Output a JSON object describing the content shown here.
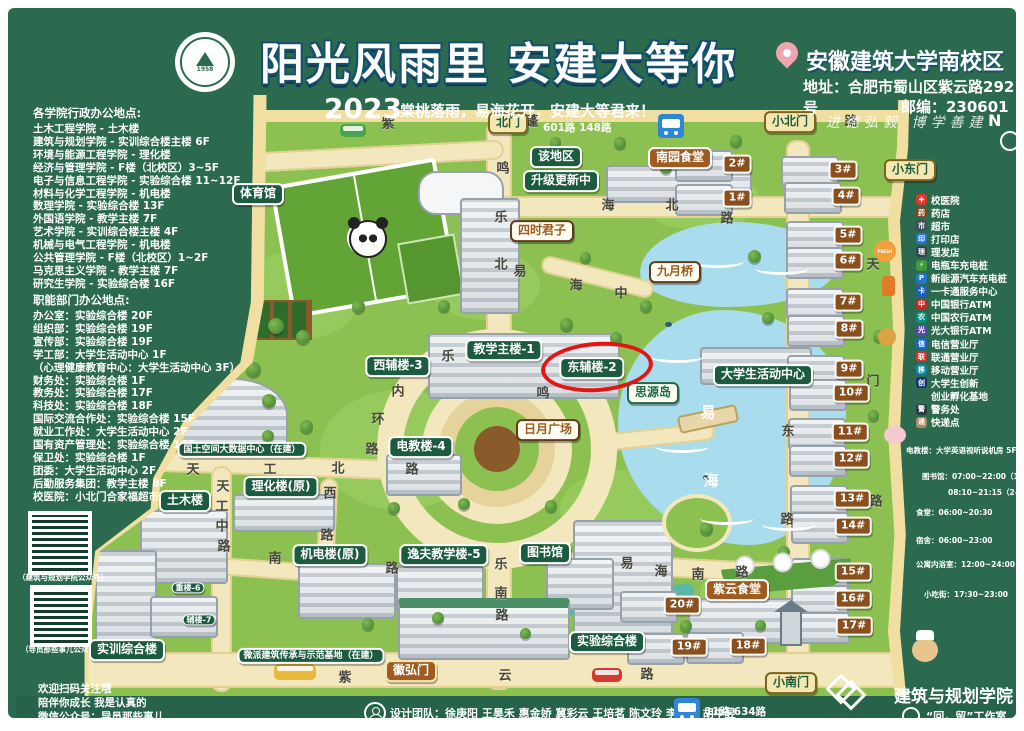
{
  "header": {
    "seal_year": "1958",
    "title": "阳光风雨里 安建大等你",
    "year": "2023",
    "subtitle": "棠桃落雨，易海花开，安建大等君来！",
    "campus": "安徽建筑大学南校区",
    "address": "地址：合肥市蜀山区紫云路292号",
    "postcode": "邮编：230601",
    "motto": "进德弘毅 博学善建",
    "compass": "N"
  },
  "college_offices": {
    "title": "各学院行政办公地点:",
    "items": [
      "土木工程学院 - 土木楼",
      "建筑与规划学院 - 实训综合楼主楼 6F",
      "环境与能源工程学院 - 理化楼",
      "经济与管理学院 - F楼（北校区）3~5F",
      "电子与信息工程学院 - 实验综合楼 11~12F",
      "材料与化学工程学院 - 机电楼",
      "数理学院 - 实验综合楼 13F",
      "外国语学院 - 教学主楼 7F",
      "艺术学院 - 实训综合楼主楼 4F",
      "机械与电气工程学院 - 机电楼",
      "公共管理学院 - F楼（北校区）1~2F",
      "马克思主义学院 - 教学主楼 7F",
      "研究生学院 - 实验综合楼 16F"
    ]
  },
  "department_offices": {
    "title": "职能部门办公地点:",
    "items": [
      "办公室：实验综合楼 20F",
      "组织部：实验综合楼 19F",
      "宣传部：实验综合楼 19F",
      "学工部：大学生活动中心 1F",
      "（心理健康教育中心：大学生活动中心 3F）",
      "财务处：实验综合楼 1F",
      "教务处：实验综合楼 17F",
      "科技处：实验综合楼 18F",
      "国际交流合作处：实验综合楼 15F",
      "就业工作处：大学生活动中心 2F",
      "国有资产管理处：实验综合楼 16F",
      "保卫处：实验综合楼 1F",
      "团委：大学生活动中心 2F",
      "后勤服务集团：教学主楼 8F",
      "校医院：小北门合家福超市旁边"
    ]
  },
  "legend": {
    "items": [
      {
        "label": "校医院",
        "color": "#d93a2f",
        "glyph": "✚"
      },
      {
        "label": "药店",
        "color": "#7a4a21",
        "glyph": "药"
      },
      {
        "label": "超市",
        "color": "#3d4f5c",
        "glyph": "市"
      },
      {
        "label": "打印店",
        "color": "#2277cc",
        "glyph": "印"
      },
      {
        "label": "理发店",
        "color": "#32424e",
        "glyph": "理"
      },
      {
        "label": "电瓶车充电桩",
        "color": "#3f9a3a",
        "glyph": "⚡"
      },
      {
        "label": "新能源汽车充电桩",
        "color": "#2277cc",
        "glyph": "P"
      },
      {
        "label": "一卡通服务中心",
        "color": "#1b5fb8",
        "glyph": "卡"
      },
      {
        "label": "中国银行ATM",
        "color": "#c22b23",
        "glyph": "中"
      },
      {
        "label": "中国农行ATM",
        "color": "#0e8e7c",
        "glyph": "农"
      },
      {
        "label": "光大银行ATM",
        "color": "#5448a8",
        "glyph": "光"
      },
      {
        "label": "电信营业厅",
        "color": "#1b66c9",
        "glyph": "信"
      },
      {
        "label": "联通营业厅",
        "color": "#d0352c",
        "glyph": "联"
      },
      {
        "label": "移动营业厅",
        "color": "#0f8aa0",
        "glyph": "移"
      },
      {
        "label": "大学生创新",
        "color": "#15356e",
        "glyph": "创"
      },
      {
        "label": "创业孵化基地",
        "color": "",
        "glyph": ""
      },
      {
        "label": "警务处",
        "color": "#2c3a45",
        "glyph": "警"
      },
      {
        "label": "快递点",
        "color": "#b08968",
        "glyph": "递"
      }
    ]
  },
  "hours": {
    "lines": [
      {
        "t": "电教楼：大学英语视听说机房 5F",
        "x": 906,
        "y": 445
      },
      {
        "t": "图书馆：07:00~22:00（1F）",
        "x": 922,
        "y": 471
      },
      {
        "t": "08:10~21:15（2-5F）",
        "x": 948,
        "y": 487
      },
      {
        "t": "食堂：06:00~20:30",
        "x": 916,
        "y": 507
      },
      {
        "t": "宿舍：06:00~23:00",
        "x": 916,
        "y": 535
      },
      {
        "t": "公寓内浴室：12:00~24:00",
        "x": 916,
        "y": 559
      },
      {
        "t": "小吃街：17:30~23:00",
        "x": 924,
        "y": 589
      }
    ]
  },
  "qr_panel": {
    "caption1": "（建筑与规划学院公众号）",
    "caption2": "（导员那些事儿公众号）",
    "line1": "欢迎扫码关注哦",
    "line2": "陪伴你成长 我是认真的",
    "line3": "微信公众号：导员那些事儿"
  },
  "footer": {
    "team": "设计团队：徐庚阳 王昊禾 惠金娇 冀彩云 王培茗 陈文玲 李云柯 胡中昱",
    "college": "建筑与规划学院",
    "studio": "“回，留”工作室"
  },
  "buses": {
    "north": "601路 148路",
    "south": "11路 634路"
  },
  "map": {
    "labels": [
      {
        "t": "北门",
        "x": 508,
        "y": 123,
        "k": "gate"
      },
      {
        "t": "小北门",
        "x": 790,
        "y": 122,
        "k": "gate"
      },
      {
        "t": "小东门",
        "x": 910,
        "y": 170,
        "k": "gate"
      },
      {
        "t": "小南门",
        "x": 791,
        "y": 683,
        "k": "gate"
      },
      {
        "t": "徽弘门",
        "x": 411,
        "y": 671,
        "k": "gateb"
      },
      {
        "t": "体育馆",
        "x": 258,
        "y": 194,
        "k": "bldg"
      },
      {
        "t": "该地区",
        "x": 556,
        "y": 157,
        "k": "bldg"
      },
      {
        "t": "升级更新中",
        "x": 561,
        "y": 181,
        "k": "bldg"
      },
      {
        "t": "教学主楼-1",
        "x": 504,
        "y": 350,
        "k": "bldg"
      },
      {
        "t": "西辅楼-3",
        "x": 398,
        "y": 366,
        "k": "bldg"
      },
      {
        "t": "东辅楼-2",
        "x": 592,
        "y": 368,
        "k": "bldg",
        "hl": 1
      },
      {
        "t": "大学生活动中心",
        "x": 763,
        "y": 375,
        "k": "bldg"
      },
      {
        "t": "电教楼-4",
        "x": 421,
        "y": 447,
        "k": "bldg"
      },
      {
        "t": "国土空间大数据中心（在建）",
        "x": 242,
        "y": 450,
        "k": "bldg",
        "s": "s"
      },
      {
        "t": "土木楼",
        "x": 185,
        "y": 501,
        "k": "bldg"
      },
      {
        "t": "理化楼(原)",
        "x": 281,
        "y": 487,
        "k": "bldg"
      },
      {
        "t": "机电楼(原)",
        "x": 330,
        "y": 555,
        "k": "bldg"
      },
      {
        "t": "逸夫教学楼-5",
        "x": 444,
        "y": 555,
        "k": "bldg"
      },
      {
        "t": "图书馆",
        "x": 545,
        "y": 553,
        "k": "bldg"
      },
      {
        "t": "实验综合楼",
        "x": 607,
        "y": 642,
        "k": "bldg"
      },
      {
        "t": "实训综合楼",
        "x": 127,
        "y": 650,
        "k": "bldg"
      },
      {
        "t": "微派建筑传承与示范基地（在建）",
        "x": 311,
        "y": 656,
        "k": "bldg",
        "s": "s"
      },
      {
        "t": "重楼-6",
        "x": 188,
        "y": 588,
        "k": "bldg",
        "s": "t"
      },
      {
        "t": "辅楼-7",
        "x": 199,
        "y": 620,
        "k": "bldg",
        "s": "t"
      },
      {
        "t": "四时君子",
        "x": 542,
        "y": 231,
        "k": "spot"
      },
      {
        "t": "九月桥",
        "x": 675,
        "y": 272,
        "k": "spot"
      },
      {
        "t": "日月广场",
        "x": 548,
        "y": 430,
        "k": "spot"
      },
      {
        "t": "思源岛",
        "x": 653,
        "y": 393,
        "k": "island"
      },
      {
        "t": "南园食堂",
        "x": 680,
        "y": 158,
        "k": "food"
      },
      {
        "t": "紫云食堂",
        "x": 737,
        "y": 590,
        "k": "food"
      },
      {
        "t": "1#",
        "x": 737,
        "y": 198,
        "k": "dorm"
      },
      {
        "t": "2#",
        "x": 737,
        "y": 164,
        "k": "dorm"
      },
      {
        "t": "3#",
        "x": 843,
        "y": 170,
        "k": "dorm"
      },
      {
        "t": "4#",
        "x": 846,
        "y": 196,
        "k": "dorm"
      },
      {
        "t": "5#",
        "x": 848,
        "y": 235,
        "k": "dorm"
      },
      {
        "t": "6#",
        "x": 848,
        "y": 261,
        "k": "dorm"
      },
      {
        "t": "7#",
        "x": 848,
        "y": 302,
        "k": "dorm"
      },
      {
        "t": "8#",
        "x": 849,
        "y": 329,
        "k": "dorm"
      },
      {
        "t": "9#",
        "x": 849,
        "y": 369,
        "k": "dorm"
      },
      {
        "t": "10#",
        "x": 851,
        "y": 393,
        "k": "dorm"
      },
      {
        "t": "11#",
        "x": 850,
        "y": 432,
        "k": "dorm"
      },
      {
        "t": "12#",
        "x": 851,
        "y": 459,
        "k": "dorm"
      },
      {
        "t": "13#",
        "x": 852,
        "y": 499,
        "k": "dorm"
      },
      {
        "t": "14#",
        "x": 853,
        "y": 526,
        "k": "dorm"
      },
      {
        "t": "15#",
        "x": 853,
        "y": 572,
        "k": "dorm"
      },
      {
        "t": "16#",
        "x": 853,
        "y": 599,
        "k": "dorm"
      },
      {
        "t": "17#",
        "x": 854,
        "y": 626,
        "k": "dorm"
      },
      {
        "t": "18#",
        "x": 748,
        "y": 646,
        "k": "dorm"
      },
      {
        "t": "19#",
        "x": 689,
        "y": 647,
        "k": "dorm"
      },
      {
        "t": "20#",
        "x": 682,
        "y": 605,
        "k": "dorm"
      }
    ],
    "road_chars": [
      {
        "c": "紫",
        "x": 388,
        "y": 122
      },
      {
        "c": "蓬",
        "x": 532,
        "y": 120
      },
      {
        "c": "路",
        "x": 851,
        "y": 120
      },
      {
        "c": "鸣",
        "x": 503,
        "y": 167
      },
      {
        "c": "乐",
        "x": 501,
        "y": 216
      },
      {
        "c": "北",
        "x": 501,
        "y": 263
      },
      {
        "c": "海",
        "x": 608,
        "y": 204
      },
      {
        "c": "北",
        "x": 672,
        "y": 204
      },
      {
        "c": "路",
        "x": 727,
        "y": 217
      },
      {
        "c": "易",
        "x": 520,
        "y": 270
      },
      {
        "c": "海",
        "x": 576,
        "y": 284
      },
      {
        "c": "中",
        "x": 621,
        "y": 292
      },
      {
        "c": "乐",
        "x": 448,
        "y": 355
      },
      {
        "c": "鸣",
        "x": 543,
        "y": 392
      },
      {
        "c": "内",
        "x": 398,
        "y": 390
      },
      {
        "c": "环",
        "x": 378,
        "y": 418
      },
      {
        "c": "路",
        "x": 372,
        "y": 448
      },
      {
        "c": "天",
        "x": 193,
        "y": 468
      },
      {
        "c": "工",
        "x": 270,
        "y": 468
      },
      {
        "c": "北",
        "x": 338,
        "y": 467
      },
      {
        "c": "路",
        "x": 412,
        "y": 468
      },
      {
        "c": "天",
        "x": 223,
        "y": 485
      },
      {
        "c": "工",
        "x": 222,
        "y": 505
      },
      {
        "c": "中",
        "x": 222,
        "y": 525
      },
      {
        "c": "路",
        "x": 224,
        "y": 545
      },
      {
        "c": "西",
        "x": 330,
        "y": 492
      },
      {
        "c": "路",
        "x": 327,
        "y": 534
      },
      {
        "c": "南",
        "x": 275,
        "y": 557
      },
      {
        "c": "路",
        "x": 392,
        "y": 567
      },
      {
        "c": "乐",
        "x": 501,
        "y": 563
      },
      {
        "c": "南",
        "x": 501,
        "y": 592
      },
      {
        "c": "路",
        "x": 502,
        "y": 614
      },
      {
        "c": "易",
        "x": 627,
        "y": 562
      },
      {
        "c": "海",
        "x": 661,
        "y": 570
      },
      {
        "c": "南",
        "x": 698,
        "y": 573
      },
      {
        "c": "路",
        "x": 742,
        "y": 571
      },
      {
        "c": "东",
        "x": 788,
        "y": 430
      },
      {
        "c": "路",
        "x": 787,
        "y": 518
      },
      {
        "c": "天",
        "x": 873,
        "y": 263
      },
      {
        "c": "门",
        "x": 873,
        "y": 380
      },
      {
        "c": "路",
        "x": 876,
        "y": 500
      },
      {
        "c": "紫",
        "x": 345,
        "y": 676
      },
      {
        "c": "云",
        "x": 505,
        "y": 674
      },
      {
        "c": "路",
        "x": 647,
        "y": 673
      }
    ],
    "lake_chars": [
      {
        "c": "易",
        "x": 708,
        "y": 412
      },
      {
        "c": "海",
        "x": 711,
        "y": 480
      }
    ]
  }
}
